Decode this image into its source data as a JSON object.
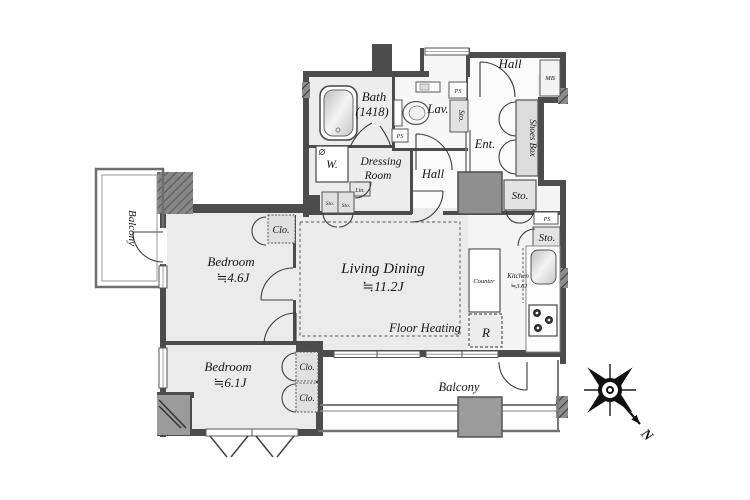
{
  "rooms": {
    "bath": {
      "name": "Bath",
      "size": "(1418)"
    },
    "lav": {
      "name": "Lav."
    },
    "hall_upper": {
      "name": "Hall"
    },
    "hall_inner": {
      "name": "Hall"
    },
    "entrance": {
      "name": "Ent."
    },
    "shoes_box": {
      "name": "Shoes Box"
    },
    "mail_box": {
      "name": "MB"
    },
    "dressing_room": {
      "line1": "Dressing",
      "line2": "Room"
    },
    "washer": {
      "name": "W."
    },
    "linen": {
      "name": "Lin."
    },
    "storage": {
      "name": "Sto."
    },
    "pipe_space": {
      "name": "PS"
    },
    "closet": {
      "name": "Clo."
    },
    "bedroom_1": {
      "name": "Bedroom",
      "size": "≒4.6J"
    },
    "bedroom_2": {
      "name": "Bedroom",
      "size": "≒6.1J"
    },
    "living_dining": {
      "name": "Living Dining",
      "size": "≒11.2J"
    },
    "floor_heating": {
      "name": "Floor Heating"
    },
    "kitchen": {
      "name": "Kitchen",
      "size": "≒3.6J"
    },
    "counter": {
      "name": "Counter"
    },
    "refrigerator": {
      "name": "R"
    },
    "balcony_left": {
      "name": "Balcony"
    },
    "balcony_bottom": {
      "name": "Balcony"
    }
  },
  "compass": {
    "north_label": "N"
  },
  "colors": {
    "wall": "#4c4c4c",
    "room_fill": "#ebebeb",
    "white_fill": "#f9f9f9",
    "pillar_fill": "#8f8f8f",
    "balcony_block": "#9b9b9b",
    "text": "#151515"
  }
}
